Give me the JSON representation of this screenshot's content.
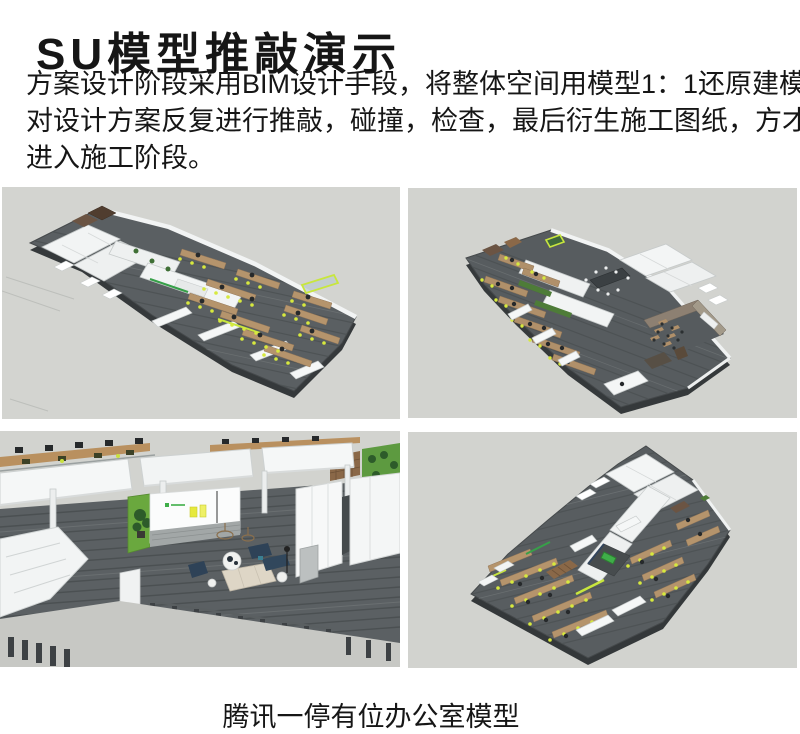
{
  "header": {
    "title": "SU模型推敲演示"
  },
  "intro": {
    "lines": [
      "方案设计阶段采用BIM设计手段，将整体空间用模型1：1还原建模，",
      "对设计方案反复进行推敲，碰撞，检查，最后衍生施工图纸，方才",
      "进入施工阶段。"
    ]
  },
  "caption": {
    "text": "腾讯一停有位办公室模型"
  },
  "palette": {
    "canvas_background": "#d3d4d0",
    "floor_gray": "#585d60",
    "plate_side_dark": "#35393b",
    "wall_white": "#f4f6f6",
    "wood_desk": "#b5946c",
    "accent_green": "#3fae49",
    "lime_chair": "#d7e93e",
    "planter_green": "#4e7c38",
    "navy_sofa": "#2e4257",
    "reception_green": "#6aa83e",
    "yellow_box": "#e6e93c",
    "taupe_wall": "#8d8072",
    "text_black": "#161616"
  }
}
